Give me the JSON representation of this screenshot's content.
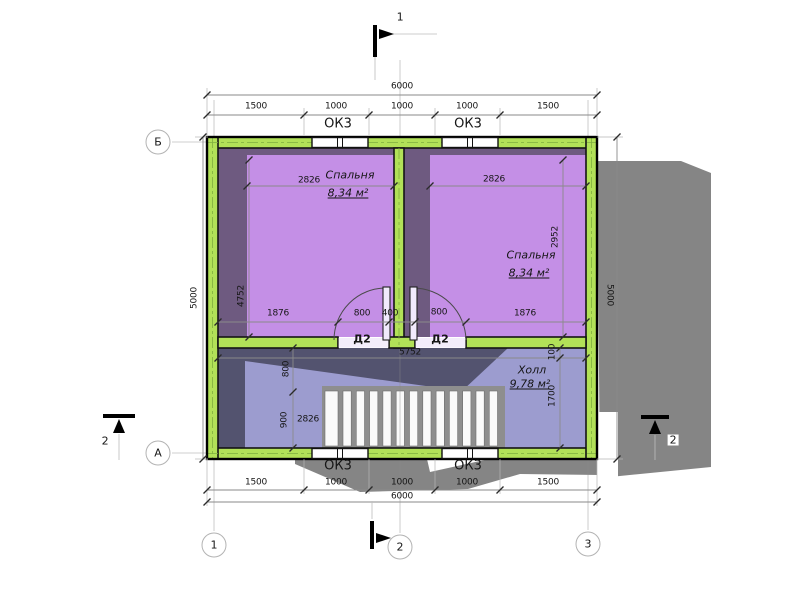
{
  "window_label": "ОК3",
  "door_label": "Д2",
  "rooms": {
    "bedroom_left": {
      "name": "Спальня",
      "area": "8,34 м²"
    },
    "bedroom_right": {
      "name": "Спальня",
      "area": "8,34 м²"
    },
    "hall": {
      "name": "Холл",
      "area": "9,78 м²"
    }
  },
  "axes": {
    "b": "Б",
    "a": "А",
    "c1": "1",
    "c2": "2",
    "c3": "3"
  },
  "sections": {
    "top": "1",
    "left": "2",
    "right": "2"
  },
  "dims": {
    "top_total": "6000",
    "top_segments": [
      "1500",
      "1000",
      "1000",
      "1000",
      "1500"
    ],
    "bottom_total": "6000",
    "bottom_segments": [
      "1500",
      "1000",
      "1000",
      "1000",
      "1500"
    ],
    "left_height": "5000",
    "right_height": "5000",
    "bed_left_width": "2826",
    "bed_right_width": "2826",
    "bed_left_depth": "4752",
    "bed_right_depth": "2952",
    "door_row": [
      "1876",
      "800",
      "400",
      "800",
      "1876"
    ],
    "hall_span": "5752",
    "wall_offset": "100",
    "hall_depth": "1700",
    "stair_upper": "800",
    "stair_lower": "900",
    "stair_width": "2826"
  },
  "colors": {
    "wall_green": "#b2e158",
    "bedroom_fill": "#c48fe6",
    "bedroom_shadow": "#6e5a80",
    "hall_fill": "#9c9ccf",
    "hall_shadow": "#53536f",
    "roof_gray": "#858585"
  }
}
